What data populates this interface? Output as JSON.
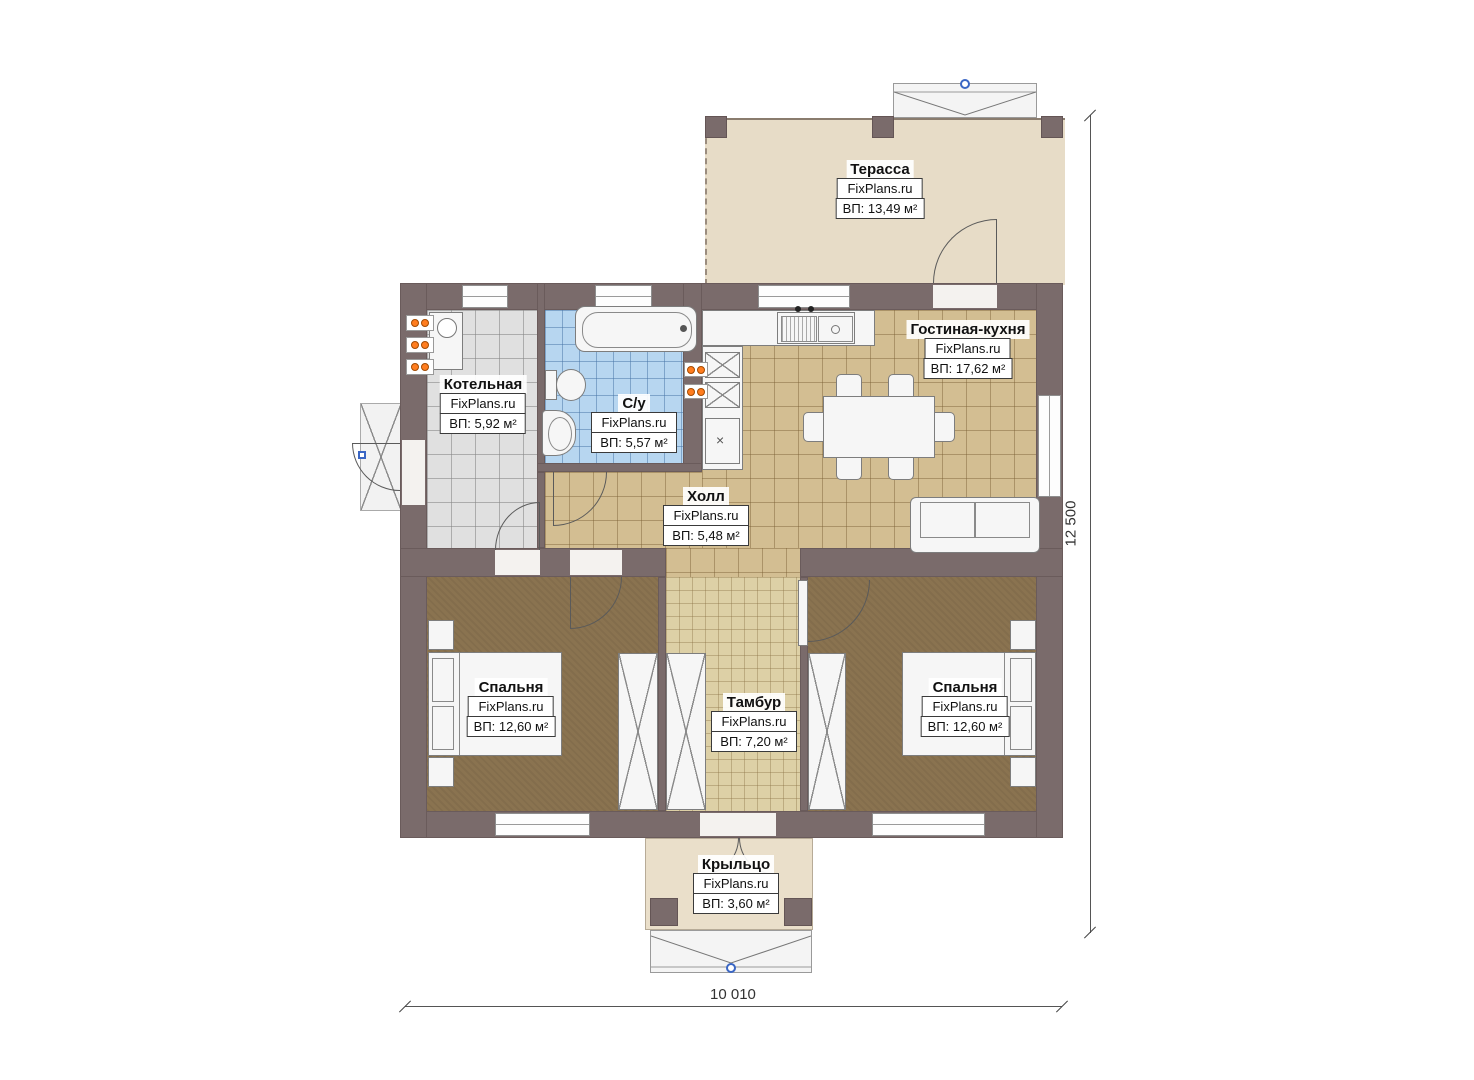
{
  "brand": "FixPlans.ru",
  "rooms": {
    "terrace": {
      "name": "Терасса",
      "brand": "FixPlans.ru",
      "area": "ВП: 13,49 м²"
    },
    "living_kitchen": {
      "name": "Гостиная-кухня",
      "brand": "FixPlans.ru",
      "area": "ВП: 17,62 м²"
    },
    "boiler": {
      "name": "Котельная",
      "brand": "FixPlans.ru",
      "area": "ВП: 5,92 м²"
    },
    "bathroom": {
      "name": "С/у",
      "brand": "FixPlans.ru",
      "area": "ВП: 5,57 м²"
    },
    "hall": {
      "name": "Холл",
      "brand": "FixPlans.ru",
      "area": "ВП: 5,48 м²"
    },
    "bedroom_left": {
      "name": "Спальня",
      "brand": "FixPlans.ru",
      "area": "ВП: 12,60 м²"
    },
    "tambur": {
      "name": "Тамбур",
      "brand": "FixPlans.ru",
      "area": "ВП: 7,20 м²"
    },
    "bedroom_right": {
      "name": "Спальня",
      "brand": "FixPlans.ru",
      "area": "ВП: 12,60 м²"
    },
    "porch": {
      "name": "Крыльцо",
      "brand": "FixPlans.ru",
      "area": "ВП: 3,60 м²"
    }
  },
  "dimensions": {
    "width_label": "10 010",
    "height_label": "12 500"
  },
  "colors": {
    "wall": "#7a6b6b",
    "terrace_floor": "#e7dcc7",
    "living_floor": "#d3be92",
    "tambur_floor": "#ddd0a6",
    "bedroom_floor": "#8a7350",
    "boiler_floor": "#e0e0e0",
    "bathroom_floor": "#b7d6f0",
    "porch_floor": "#eadfca",
    "radiator_accent": "#ff7d1f",
    "level_marker": "#3a66c4"
  }
}
